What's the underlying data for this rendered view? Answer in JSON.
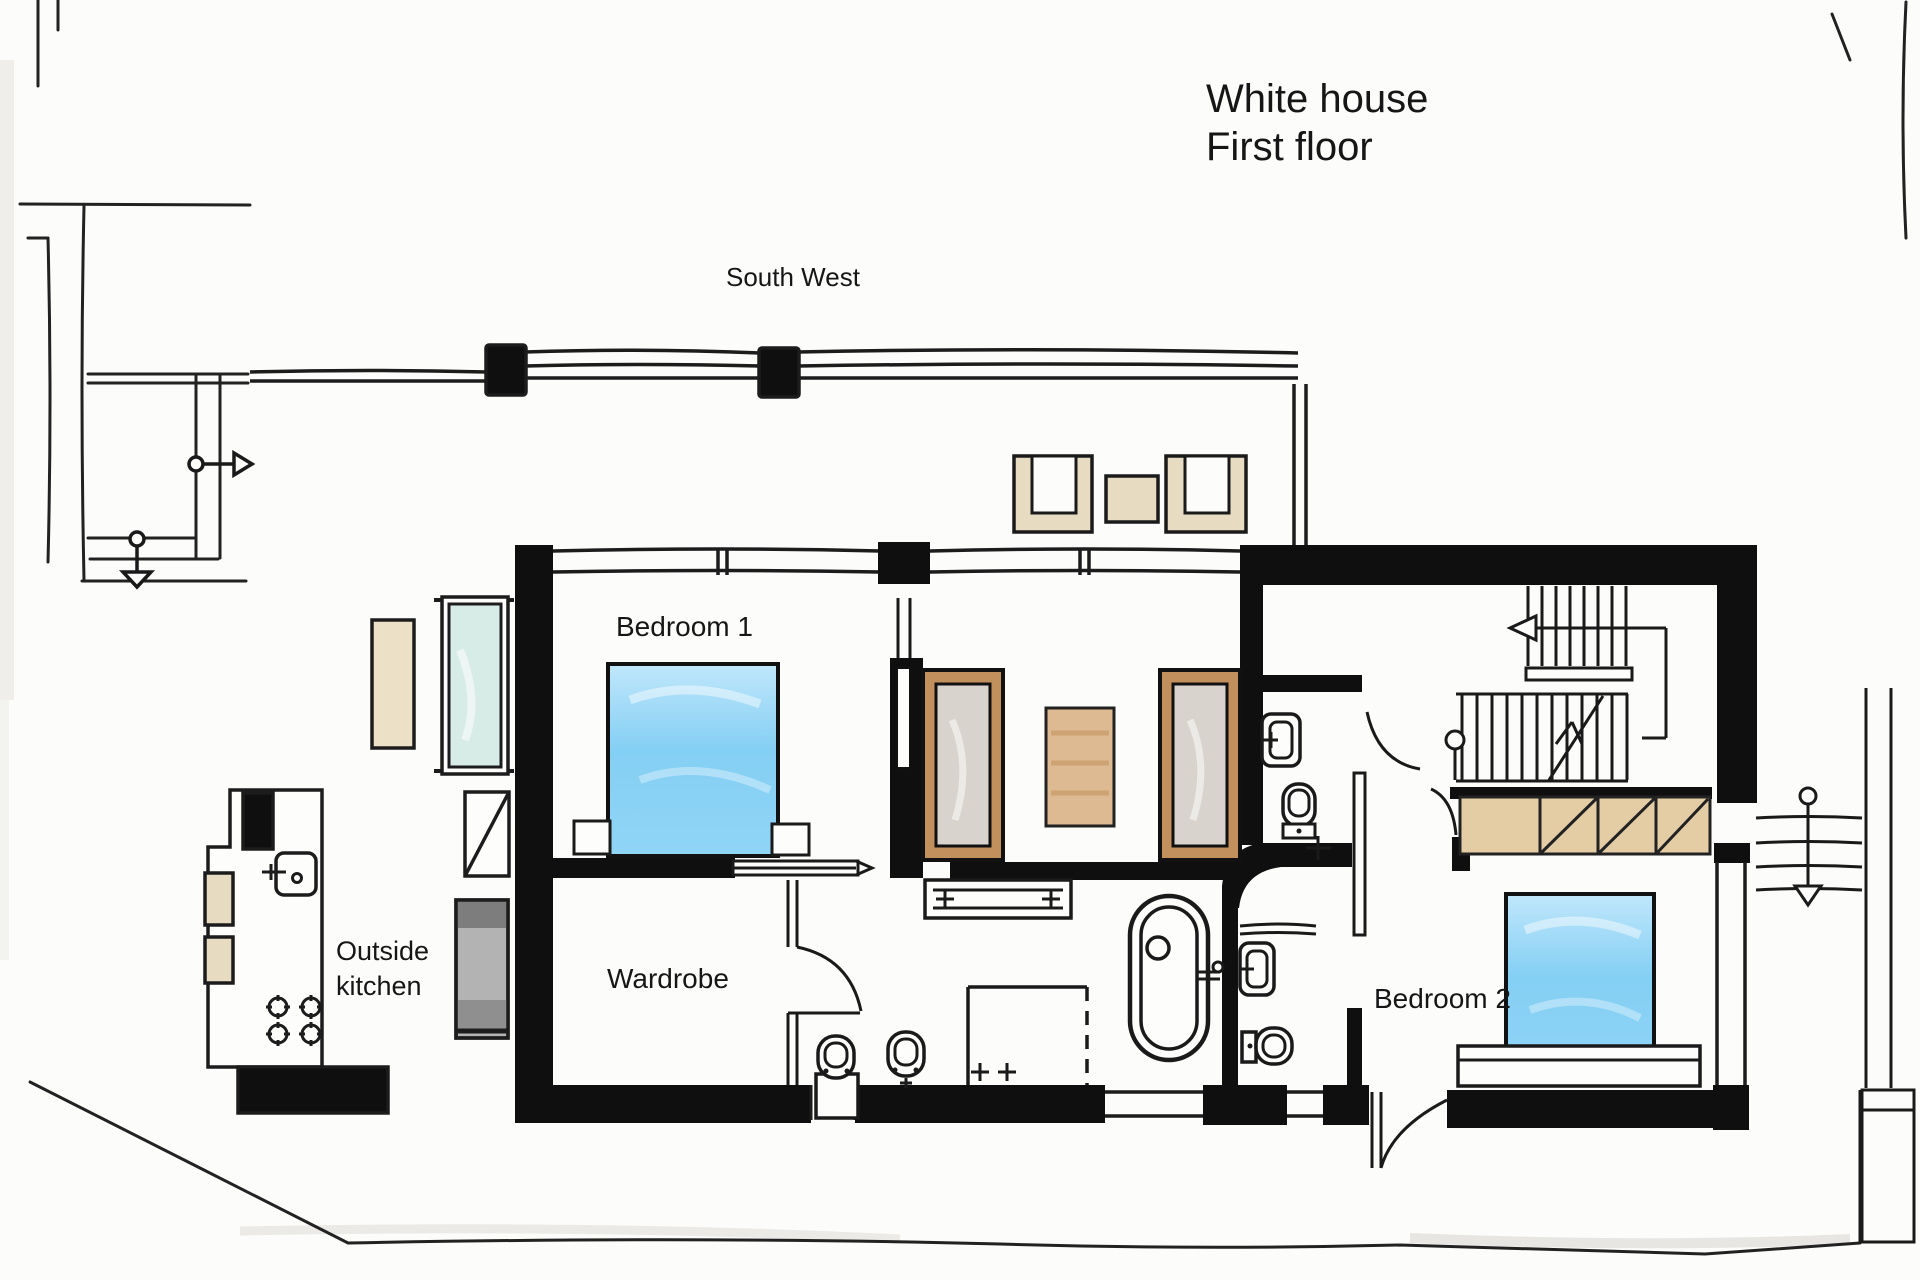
{
  "title": {
    "line1": "White house",
    "line2": "First floor"
  },
  "compass": {
    "label": "South West"
  },
  "rooms": {
    "bedroom1": {
      "label": "Bedroom 1"
    },
    "bedroom2": {
      "label": "Bedroom 2"
    },
    "wardrobe": {
      "label": "Wardrobe"
    },
    "outside_kitchen": {
      "label_line1": "Outside",
      "label_line2": "kitchen"
    }
  },
  "palette": {
    "ink": "#1a1a1a",
    "wall_black": "#0f0f0f",
    "bed_blue": "#7fccf2",
    "bed_blue_light": "#c4e9fb",
    "glass_teal": "#d7ebe7",
    "furniture_beige": "#e7dcc1",
    "rug_tan": "#deba92",
    "wood_brown": "#c2905c",
    "panel_gray": "#d8d4cd",
    "unit_gray": "#e7e5e0",
    "closet_tan": "#e4cda5",
    "grill_gray": "#a8a8a8",
    "paper": "#fcfcfa"
  },
  "fixtures": [
    "double-bed",
    "freestanding-bathtub",
    "shower-enclosure",
    "toilet",
    "bidet",
    "washbasin",
    "towel-rail",
    "wardrobe-panel",
    "dressing-bench",
    "interior-staircase",
    "exterior-staircase",
    "sliding-door",
    "swing-door",
    "kitchen-island",
    "cooktop-burners",
    "kitchen-sink",
    "bbq-grill",
    "planter",
    "glass-screen",
    "lounge-chair",
    "side-table",
    "built-in-closet"
  ]
}
